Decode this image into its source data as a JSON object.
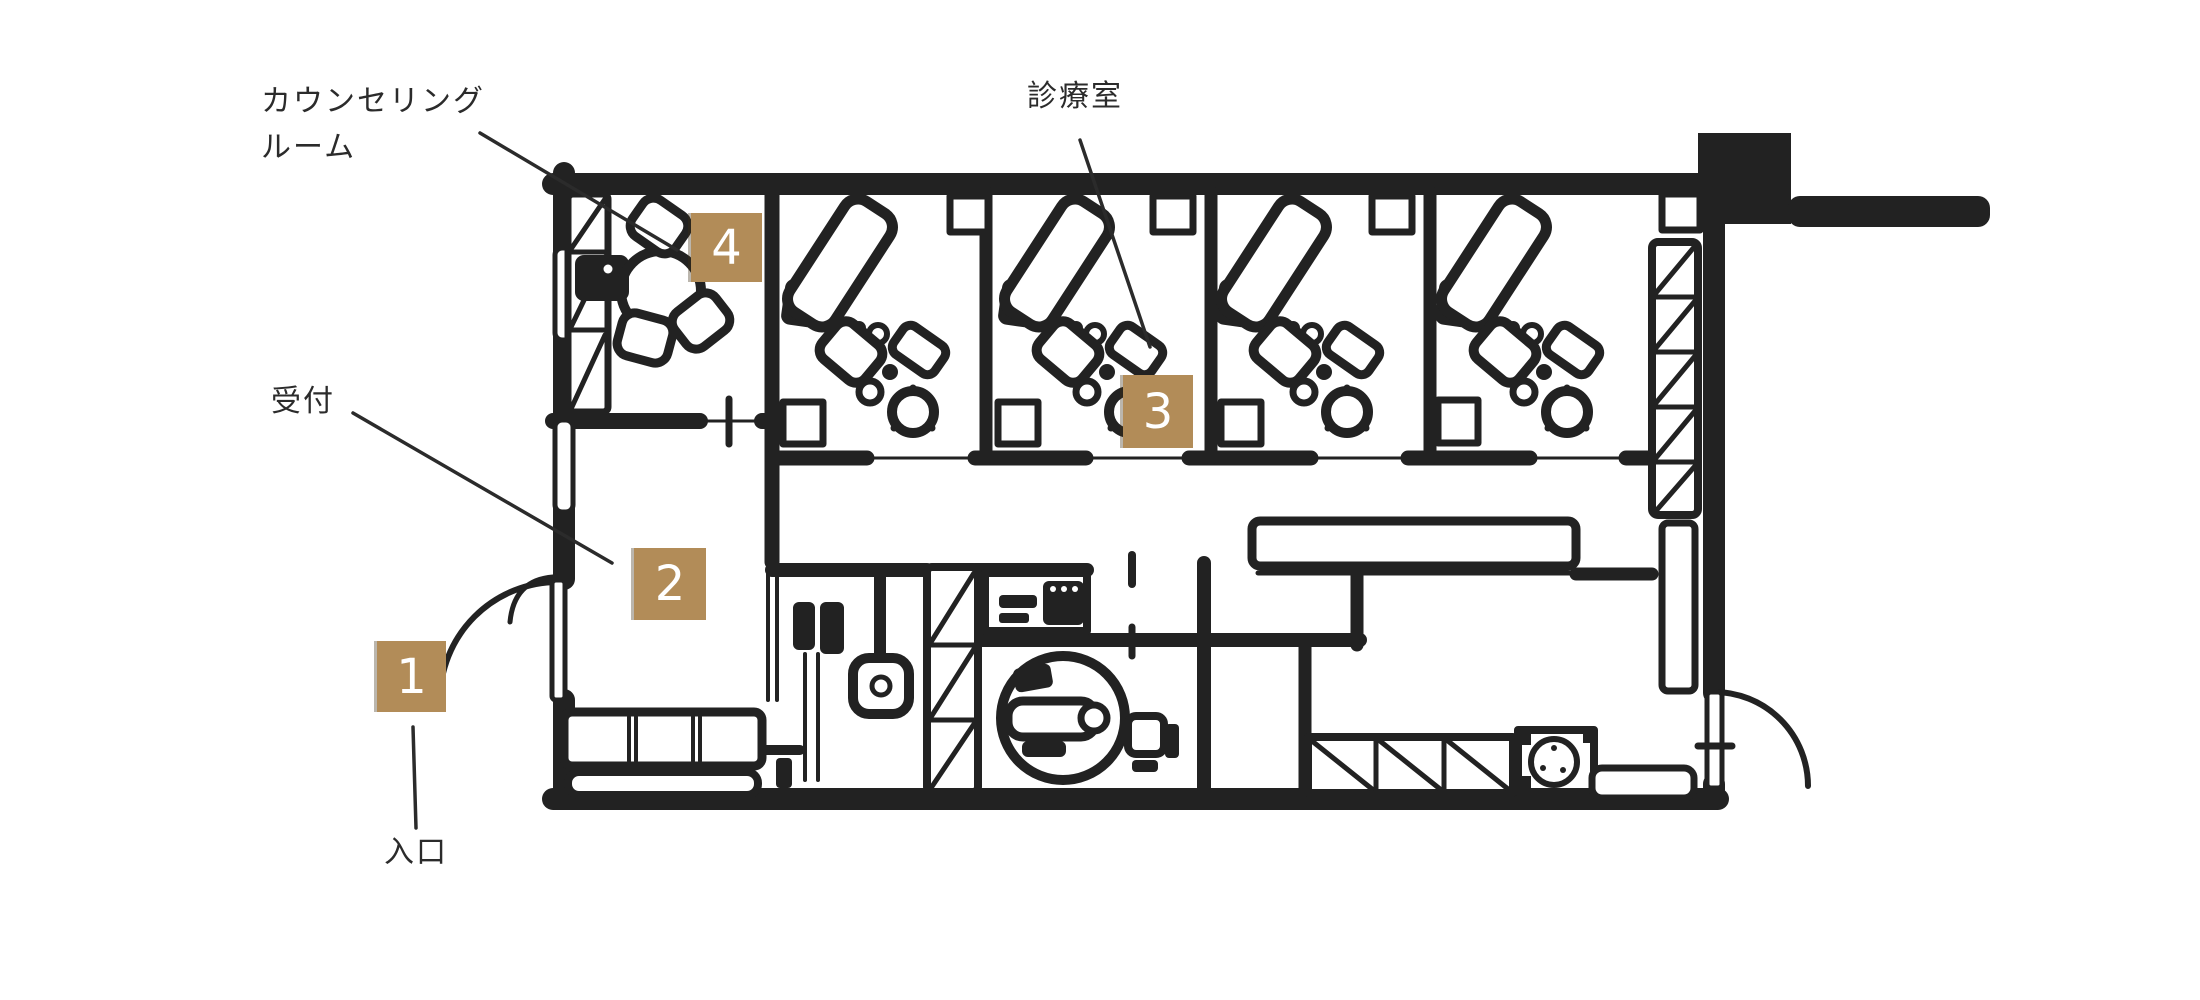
{
  "colors": {
    "background": "#ffffff",
    "ink": "#222222",
    "badge": "#b28c58",
    "badge_text": "#ffffff",
    "label_text": "#2b2b2b"
  },
  "labels": {
    "counseling_room": {
      "line1": "カウンセリング",
      "line2": "ルーム"
    },
    "treatment_room": {
      "text": "診療室"
    },
    "reception": {
      "text": "受付"
    },
    "entrance": {
      "text": "入口"
    }
  },
  "markers": [
    {
      "number": "1",
      "refers_to": "入口"
    },
    {
      "number": "2",
      "refers_to": "受付"
    },
    {
      "number": "3",
      "refers_to": "診療室"
    },
    {
      "number": "4",
      "refers_to": "カウンセリングルーム"
    }
  ]
}
